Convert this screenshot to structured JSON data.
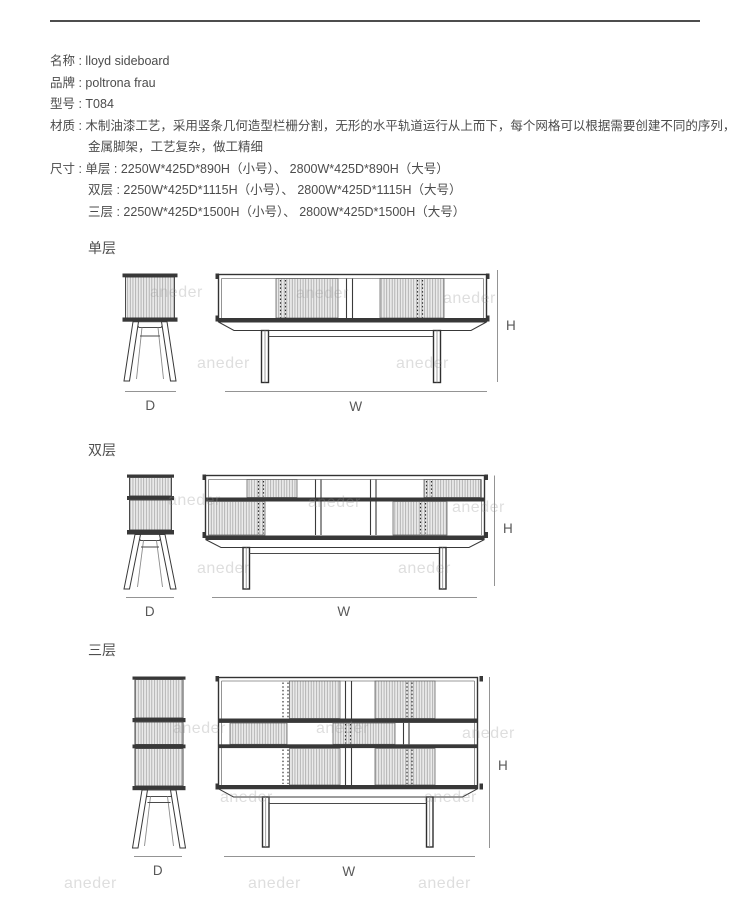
{
  "specs": {
    "name": "名称 : lloyd sideboard",
    "brand": "品牌 : poltrona frau",
    "model": "型号 : T084",
    "material_line1": "材质 : 木制油漆工艺，采用竖条几何造型栏栅分割，无形的水平轨道运行从上而下，每个网格可以根据需要创建不同的序列，",
    "material_line2": "金属脚架，工艺复杂，做工精细",
    "size_line1": "尺寸 : 单层 : 2250W*425D*890H（小号）、 2800W*425D*890H（大号）",
    "size_line2": "双层 : 2250W*425D*1115H（小号）、 2800W*425D*1115H（大号）",
    "size_line3": "三层 : 2250W*425D*1500H（小号）、 2800W*425D*1500H（大号）"
  },
  "figures": [
    {
      "title": "单层",
      "d": "D",
      "w": "W",
      "h": "H"
    },
    {
      "title": "双层",
      "d": "D",
      "w": "W",
      "h": "H"
    },
    {
      "title": "三层",
      "d": "D",
      "w": "W",
      "h": "H"
    }
  ],
  "watermark": {
    "text": "aneder"
  },
  "colors": {
    "ink": "#383838",
    "text": "#4c4c4c",
    "dim_line": "#949494"
  }
}
